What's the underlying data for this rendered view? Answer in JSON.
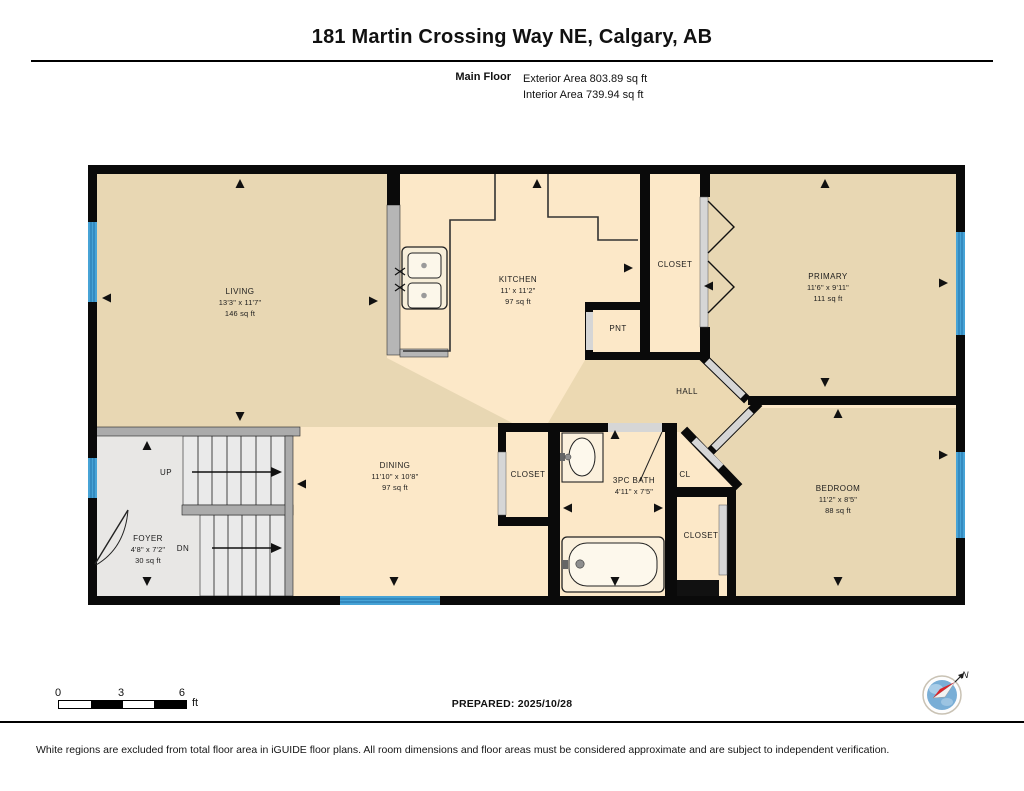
{
  "header": {
    "title": "181 Martin Crossing Way NE, Calgary, AB",
    "floor_label": "Main Floor",
    "exterior_area": "Exterior Area 803.89 sq ft",
    "interior_area": "Interior Area 739.94 sq ft"
  },
  "rooms": {
    "living": {
      "name": "LIVING",
      "dims": "13'3\" x 11'7\"",
      "area": "146 sq ft"
    },
    "kitchen": {
      "name": "KITCHEN",
      "dims": "11' x 11'2\"",
      "area": "97 sq ft"
    },
    "dining": {
      "name": "DINING",
      "dims": "11'10\" x 10'8\"",
      "area": "97 sq ft"
    },
    "primary": {
      "name": "PRIMARY",
      "dims": "11'6\" x 9'11\"",
      "area": "111 sq ft"
    },
    "bedroom": {
      "name": "BEDROOM",
      "dims": "11'2\" x 8'5\"",
      "area": "88 sq ft"
    },
    "bath": {
      "name": "3PC BATH",
      "dims": "4'11\" x 7'5\""
    },
    "foyer": {
      "name": "FOYER",
      "dims": "4'8\" x 7'2\"",
      "area": "30 sq ft"
    },
    "hall": {
      "name": "HALL"
    },
    "pantry": {
      "name": "PNT"
    },
    "closet_top": {
      "name": "CLOSET"
    },
    "closet_mid": {
      "name": "CLOSET"
    },
    "closet_bedroom": {
      "name": "CLOSET"
    },
    "cl": {
      "name": "CL"
    },
    "stairs": {
      "up": "UP",
      "dn": "DN"
    }
  },
  "footer": {
    "scale": {
      "t0": "0",
      "t3": "3",
      "t6": "6",
      "unit": "ft"
    },
    "prepared": "PREPARED: 2025/10/28",
    "compass_n": "N",
    "disclaimer": "White regions are excluded from total floor area in iGUIDE floor plans. All room dimensions and floor areas must be considered approximate and are subject to independent verification."
  },
  "colors": {
    "floor_tan": "#e8d7b3",
    "floor_cream": "#fce8c8",
    "floor_gray": "#e8e7e5",
    "wall_black": "#0a0a0a",
    "window_blue": "#47a3d6",
    "door_gray": "#d6d6d6"
  }
}
